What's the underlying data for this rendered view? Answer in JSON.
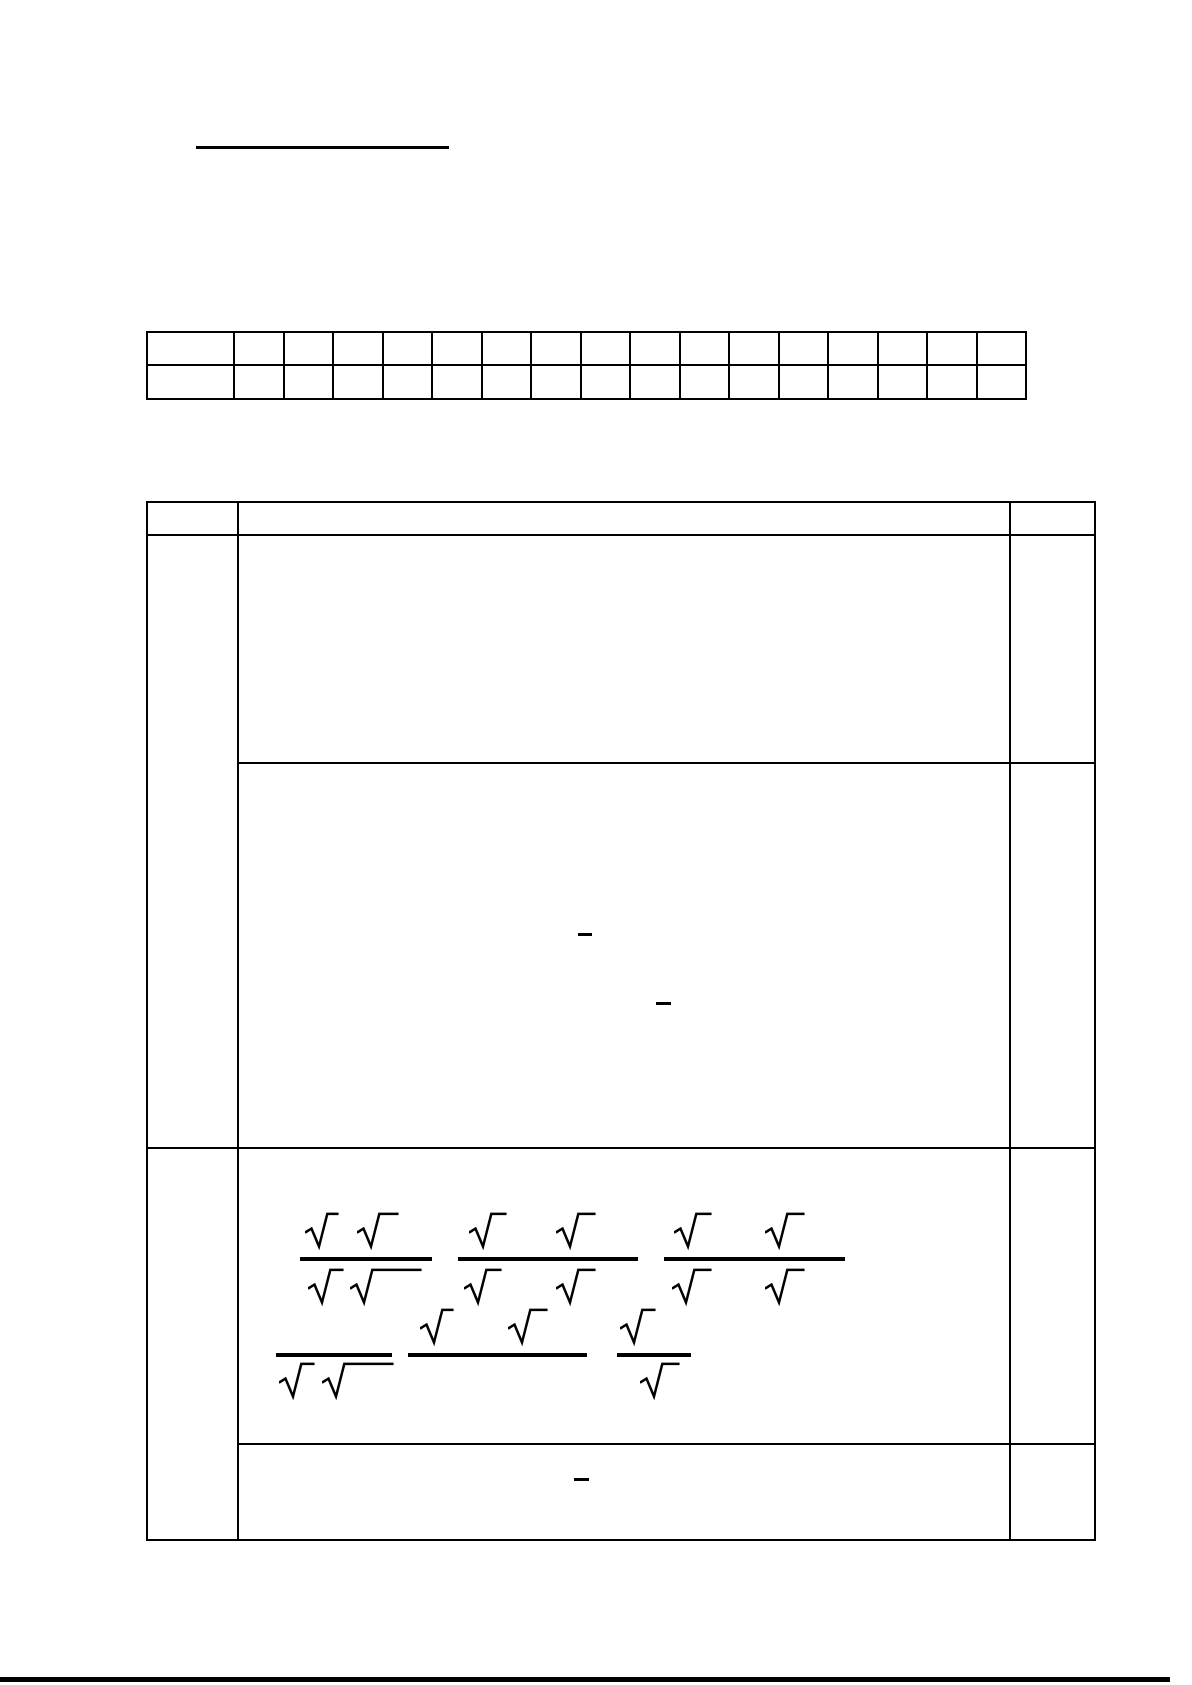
{
  "page": {
    "width": 1192,
    "height": 1685,
    "background": "#ffffff",
    "ink": "#000000",
    "visible_text": ""
  },
  "header": {
    "title_underline": {
      "x": 196,
      "y": 146,
      "w": 253,
      "h": 2.5
    }
  },
  "score_table": {
    "x": 146,
    "y": 331,
    "label_col_width": 87,
    "value_col_width": 49.5,
    "value_col_count": 16,
    "row_heights": [
      33,
      34
    ],
    "cell_text": ""
  },
  "main_table": {
    "x": 146,
    "y": 501,
    "col_widths": [
      91,
      772,
      85
    ],
    "row_heights": [
      33,
      228,
      385,
      296,
      96
    ],
    "cell_text": ""
  },
  "formulas": {
    "description": "two rows of fractions built from square-root signs with blank radicands",
    "sqrt_glyph": "√",
    "fraction_bars": [
      {
        "x": 300,
        "y": 1257,
        "w": 132,
        "h": 3.6
      },
      {
        "x": 458,
        "y": 1257,
        "w": 180,
        "h": 3.6
      },
      {
        "x": 664,
        "y": 1257,
        "w": 181,
        "h": 3.6
      },
      {
        "x": 276,
        "y": 1353,
        "w": 116,
        "h": 3.6
      },
      {
        "x": 408,
        "y": 1353,
        "w": 179,
        "h": 3.6
      },
      {
        "x": 617,
        "y": 1353,
        "w": 74,
        "h": 3.6
      }
    ],
    "radicals": [
      {
        "x": 305,
        "y": 1211,
        "ext": 10
      },
      {
        "x": 357,
        "y": 1211,
        "ext": 18
      },
      {
        "x": 308,
        "y": 1267,
        "ext": 12
      },
      {
        "x": 350,
        "y": 1267,
        "ext": 48
      },
      {
        "x": 469,
        "y": 1211,
        "ext": 14
      },
      {
        "x": 556,
        "y": 1211,
        "ext": 16
      },
      {
        "x": 464,
        "y": 1267,
        "ext": 14
      },
      {
        "x": 556,
        "y": 1267,
        "ext": 16
      },
      {
        "x": 674,
        "y": 1211,
        "ext": 14
      },
      {
        "x": 765,
        "y": 1211,
        "ext": 16
      },
      {
        "x": 672,
        "y": 1267,
        "ext": 16
      },
      {
        "x": 765,
        "y": 1267,
        "ext": 16
      },
      {
        "x": 420,
        "y": 1307,
        "ext": 10
      },
      {
        "x": 508,
        "y": 1307,
        "ext": 16
      },
      {
        "x": 620,
        "y": 1307,
        "ext": 12
      },
      {
        "x": 279,
        "y": 1361,
        "ext": 12
      },
      {
        "x": 322,
        "y": 1361,
        "ext": 48
      },
      {
        "x": 640,
        "y": 1361,
        "ext": 16
      }
    ],
    "dashes": [
      {
        "x": 578,
        "y": 933,
        "w": 14,
        "h": 2.5
      },
      {
        "x": 656,
        "y": 1002,
        "w": 15,
        "h": 2.5
      },
      {
        "x": 574,
        "y": 1478,
        "w": 15,
        "h": 2.5
      }
    ]
  },
  "footer": {
    "bar": {
      "x": 0,
      "y": 1677,
      "w": 1170,
      "h": 5
    }
  }
}
